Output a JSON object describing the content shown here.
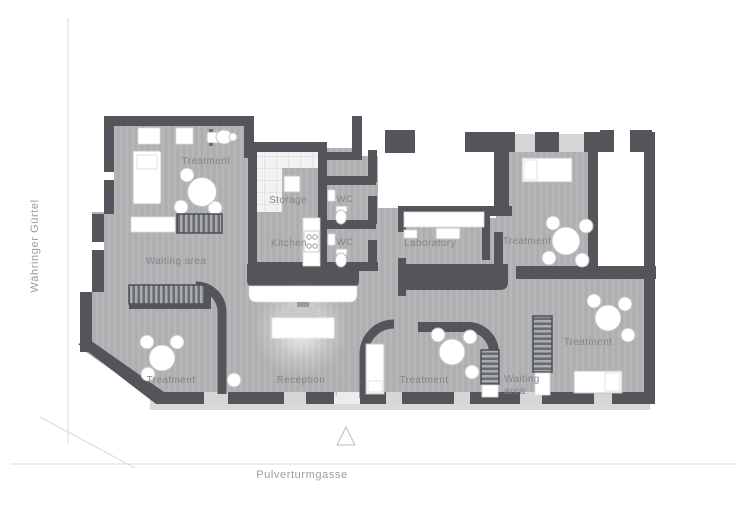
{
  "title": "Clinic floor plan",
  "streets": {
    "left": "Währinger Gürtel",
    "bottom": "Pulverturmgasse"
  },
  "rooms": {
    "treatment_tl": {
      "label": "Treatment"
    },
    "storage": {
      "label": "Storage"
    },
    "wc_top": {
      "label": "WC"
    },
    "wc_bottom": {
      "label": "WC"
    },
    "kitchen": {
      "label": "Kitchen"
    },
    "laboratory": {
      "label": "Laboratory"
    },
    "treatment_tr": {
      "label": "Treatment"
    },
    "waiting_left": {
      "label": "Waiting area"
    },
    "treatment_bl": {
      "label": "Treatment"
    },
    "reception": {
      "label": "Reception"
    },
    "treatment_bm": {
      "label": "Treatment"
    },
    "waiting_right": {
      "line1": "Waiting",
      "line2": "area"
    },
    "treatment_br": {
      "label": "Treatment"
    }
  },
  "colors": {
    "wall": "#54555a",
    "floor": "#b2b2b4",
    "sidewalk": "#d9d9d9",
    "label_text": "#84858a",
    "street_text": "#9c9c9e",
    "street_line": "#dadada",
    "furniture": "#ffffff"
  }
}
